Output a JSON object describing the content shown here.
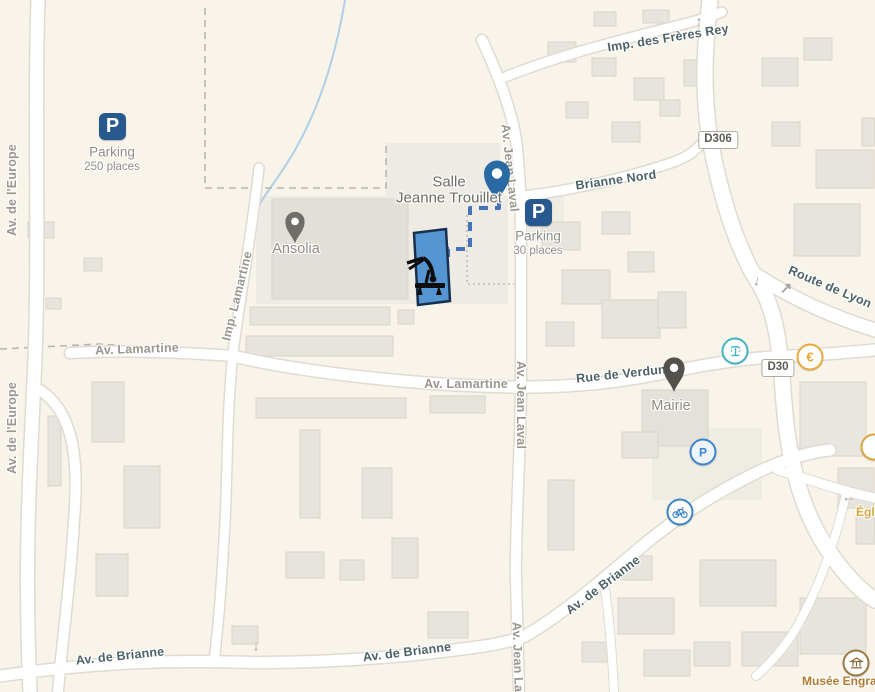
{
  "map": {
    "colors": {
      "background": "#f8f4e9",
      "road": "#ffffff",
      "road_casing": "#dfdbd1",
      "water": "#aecfe6",
      "route": "#4573ba",
      "highlight_building": "#5596d2",
      "parking_brand": "#27598f",
      "pin_blue": "#2a6aa4",
      "pin_gray": "#6f6d68",
      "pin_dark": "#53514c",
      "poi_blue": "#3d85c8",
      "poi_teal": "#45b4c2",
      "poi_orange": "#e8a62e",
      "poi_brown": "#8a6a3a",
      "street_major": "#4d6267",
      "street_minor": "#9a978e"
    },
    "streets": [
      {
        "label": "Av. de l'Europe"
      },
      {
        "label": "Av. de l'Europe"
      },
      {
        "label": "Imp. Lamartine"
      },
      {
        "label": "Av. Lamartine"
      },
      {
        "label": "Av. Lamartine"
      },
      {
        "label": "Av. Jean Laval"
      },
      {
        "label": "Av. Jean Laval"
      },
      {
        "label": "Av. Jean Laval"
      },
      {
        "label": "Imp. des Frères Rey"
      },
      {
        "label": "Brianne Nord"
      },
      {
        "label": "Route de Lyon"
      },
      {
        "label": "Rue de Verdun"
      },
      {
        "label": "Av. de Brianne"
      },
      {
        "label": "Av. de Brianne"
      },
      {
        "label": "Av. de Brianne"
      }
    ],
    "badges": [
      {
        "label": "D306"
      },
      {
        "label": "D30"
      }
    ],
    "pois": {
      "parking_main": {
        "glyph": "P",
        "title": "Parking",
        "subtitle": "250 places"
      },
      "parking_salle": {
        "glyph": "P",
        "title": "Parking",
        "subtitle": "30 places"
      },
      "salle": {
        "line1": "Salle",
        "line2": "Jeanne Trouillet"
      },
      "ansolia": {
        "label": "Ansolia"
      },
      "mairie": {
        "label": "Mairie"
      },
      "museum": {
        "label": "Musée Engra"
      },
      "eglise": {
        "label": "Égli"
      },
      "euro": {
        "glyph": "€"
      },
      "parking_circle": {
        "glyph": "P"
      }
    },
    "arrows": [
      {
        "glyph": "↑"
      },
      {
        "glyph": "↓"
      },
      {
        "glyph": "↗"
      },
      {
        "glyph": "↓"
      },
      {
        "glyph": "←"
      }
    ]
  }
}
